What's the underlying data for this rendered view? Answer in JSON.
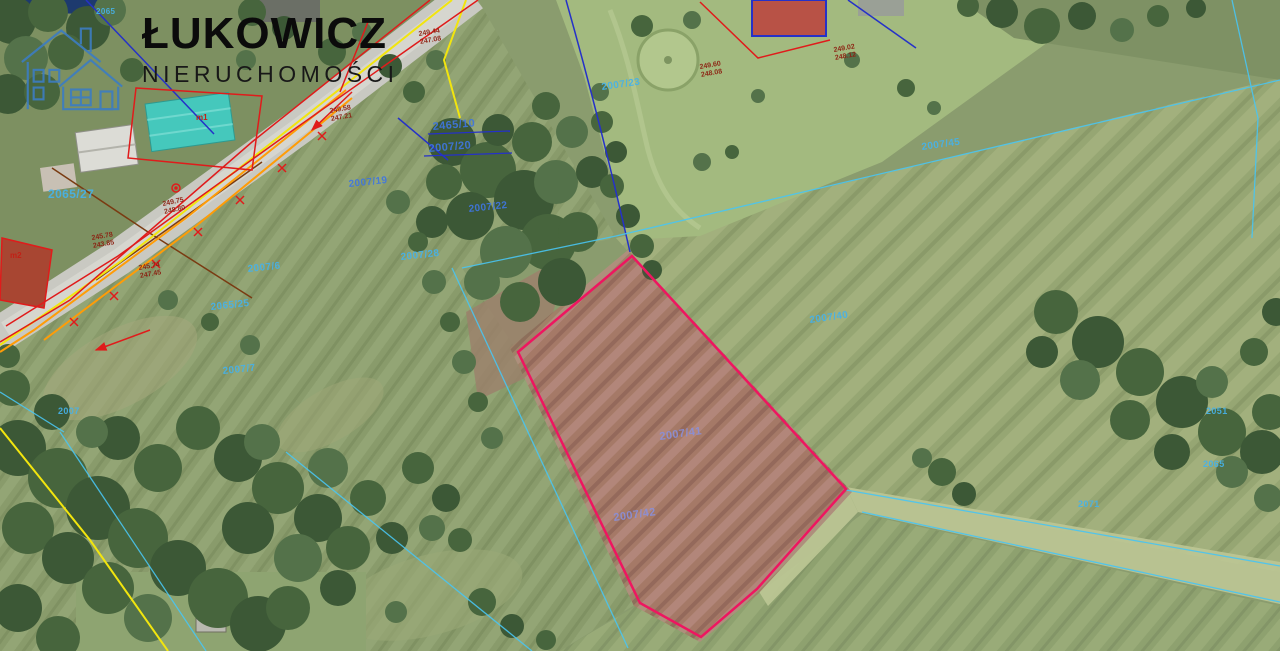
{
  "logo": {
    "title": "ŁUKOWICZ",
    "subtitle": "NIERUCHOMOŚCI"
  },
  "map": {
    "type": "aerial-cadastral",
    "highlighted_parcel": {
      "labels": [
        "2007/41",
        "2007/42"
      ],
      "outline_color": "#ee1660"
    },
    "parcel_labels": [
      {
        "text": "2465/10",
        "x": 433,
        "y": 130,
        "size": 11,
        "rot": -5,
        "color": "#3f76e0"
      },
      {
        "text": "2007/20",
        "x": 429,
        "y": 152,
        "size": 11,
        "rot": -5,
        "color": "#3f76e0"
      },
      {
        "text": "2007/23",
        "x": 602,
        "y": 90,
        "size": 10,
        "rot": -8,
        "color": "#46b2e9"
      },
      {
        "text": "2007/19",
        "x": 349,
        "y": 187,
        "size": 10,
        "rot": -6,
        "color": "#3f76e0"
      },
      {
        "text": "2007/22",
        "x": 469,
        "y": 212,
        "size": 10,
        "rot": -6,
        "color": "#3f76e0"
      },
      {
        "text": "2007/28",
        "x": 401,
        "y": 260,
        "size": 10,
        "rot": -6,
        "color": "#46b2e9"
      },
      {
        "text": "2065/27",
        "x": 48,
        "y": 198,
        "size": 12,
        "rot": 0,
        "color": "#46b2e9"
      },
      {
        "text": "2007/6",
        "x": 248,
        "y": 272,
        "size": 10,
        "rot": -6,
        "color": "#46b2e9"
      },
      {
        "text": "2065/25",
        "x": 211,
        "y": 310,
        "size": 10,
        "rot": -6,
        "color": "#46b2e9"
      },
      {
        "text": "2007/7",
        "x": 223,
        "y": 374,
        "size": 10,
        "rot": -6,
        "color": "#46b2e9"
      },
      {
        "text": "2007",
        "x": 58,
        "y": 414,
        "size": 9,
        "rot": 0,
        "color": "#46b2e9"
      },
      {
        "text": "2007/40",
        "x": 810,
        "y": 323,
        "size": 10,
        "rot": -8,
        "color": "#46b2e9"
      },
      {
        "text": "2007/45",
        "x": 922,
        "y": 150,
        "size": 10,
        "rot": -8,
        "color": "#46b2e9"
      },
      {
        "text": "2007/41",
        "x": 660,
        "y": 440,
        "size": 11,
        "rot": -8,
        "color": "#8a8fd8"
      },
      {
        "text": "2007/42",
        "x": 614,
        "y": 521,
        "size": 11,
        "rot": -8,
        "color": "#8a8fd8"
      },
      {
        "text": "2051",
        "x": 1206,
        "y": 414,
        "size": 9,
        "rot": 0,
        "color": "#46b2e9"
      },
      {
        "text": "2065",
        "x": 1203,
        "y": 467,
        "size": 9,
        "rot": 0,
        "color": "#46b2e9"
      },
      {
        "text": "2071",
        "x": 1078,
        "y": 507,
        "size": 9,
        "rot": 0,
        "color": "#46b2e9"
      },
      {
        "text": "2065",
        "x": 96,
        "y": 14,
        "size": 8,
        "rot": 0,
        "color": "#46b2e9"
      }
    ],
    "elevation_labels": [
      {
        "top": "249.44",
        "bottom": "247.08",
        "x": 419,
        "y": 36,
        "rot": -10
      },
      {
        "top": "249.58",
        "bottom": "247.21",
        "x": 330,
        "y": 113,
        "rot": -10
      },
      {
        "top": "249.60",
        "bottom": "248.08",
        "x": 700,
        "y": 69,
        "rot": -10
      },
      {
        "top": "249.02",
        "bottom": "248.12",
        "x": 834,
        "y": 52,
        "rot": -10
      },
      {
        "top": "249.75",
        "bottom": "248.80",
        "x": 163,
        "y": 206,
        "rot": -12
      },
      {
        "top": "245.78",
        "bottom": "243.85",
        "x": 92,
        "y": 240,
        "rot": -10
      },
      {
        "top": "245.74",
        "bottom": "247.45",
        "x": 139,
        "y": 270,
        "rot": -10
      }
    ],
    "marker_labels": [
      {
        "text": "m1",
        "x": 196,
        "y": 120
      },
      {
        "text": "m2",
        "x": 10,
        "y": 258
      }
    ],
    "colors": {
      "highlight_outline": "#ee1660",
      "parcel_label_blue": "#3f76e0",
      "parcel_label_cyan": "#46b2e9",
      "inner_parcel_label": "#8a8fd8",
      "elevation_red": "#8c1f10",
      "cadastral_red": "#e01b1b",
      "cadastral_yellow": "#f2e50e",
      "cadastral_orange": "#ff9c07",
      "cadastral_blue": "#2531c8",
      "cadastral_cyan": "#49c5f2",
      "logo_blue": "#3c7dc2"
    }
  }
}
